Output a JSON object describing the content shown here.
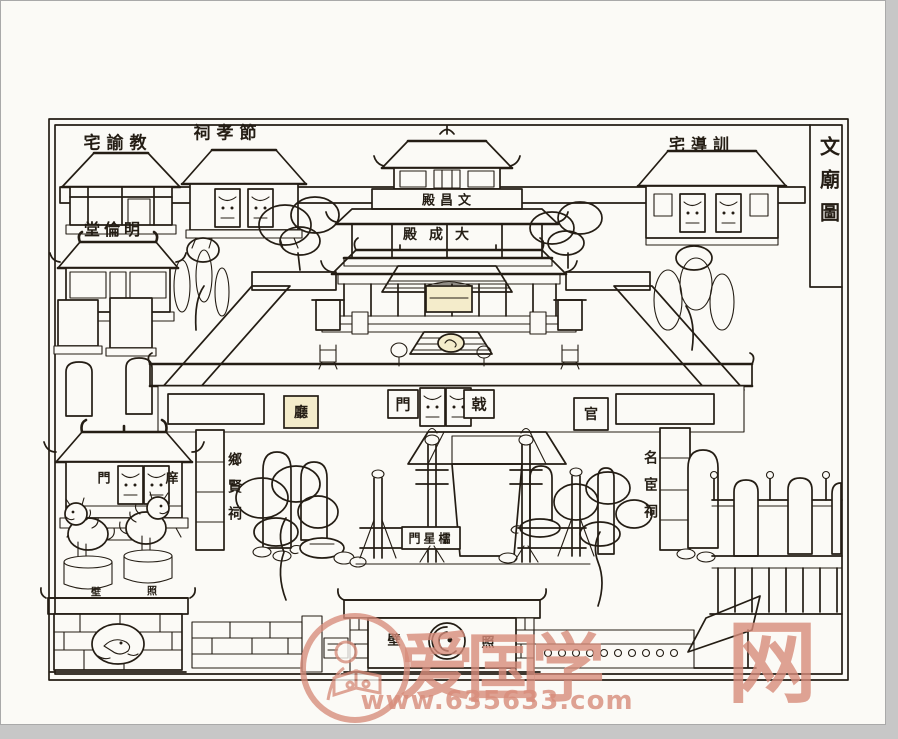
{
  "page": {
    "background": "#c7c7c7",
    "paper": "#fbfaf6",
    "ink": "#241d14",
    "plaque_tint": "#f4eccb",
    "watermark_color": "#d78c7b"
  },
  "title": {
    "reading": "文廟圖",
    "display": "文廟圖"
  },
  "labels": {
    "jiaoyu_zhai": {
      "reading": "教諭宅",
      "display": "宅諭教"
    },
    "jiexiao_ci": {
      "reading": "節孝祠",
      "display": "祠孝節"
    },
    "wenchang_dian": {
      "reading": "文昌殿",
      "display": "殿昌文"
    },
    "xundao_zhai": {
      "reading": "訓導宅",
      "display": "宅導訓"
    },
    "minglun_tang": {
      "reading": "明倫堂",
      "display": "堂倫明"
    },
    "dacheng_dian": {
      "reading": "大成殿",
      "display": "殿成大"
    },
    "ji_men": {
      "reading": "戟門",
      "left": "門",
      "right": "戟"
    },
    "guan_ting": {
      "reading": "官廳",
      "left": "廳",
      "right": "官"
    },
    "xiangxian_ci": {
      "reading": "鄉賢祠",
      "display": "鄉賢祠"
    },
    "minghuan_ci": {
      "reading": "名宦祠",
      "display": "名宦祠"
    },
    "xiang_men": {
      "reading": "庠門",
      "left": "門",
      "right": "庠"
    },
    "lingxing_men": {
      "reading": "櫺星門",
      "display": "門星櫺"
    },
    "zhao_bi": {
      "reading": "照壁",
      "left": "壁",
      "right": "照"
    },
    "zhao_bi_small": {
      "reading": "照壁",
      "left": "壁",
      "right": "照"
    }
  },
  "watermark": {
    "brand_chars": [
      "爱",
      "国",
      "学",
      "网"
    ],
    "url": "www.635633.com"
  }
}
